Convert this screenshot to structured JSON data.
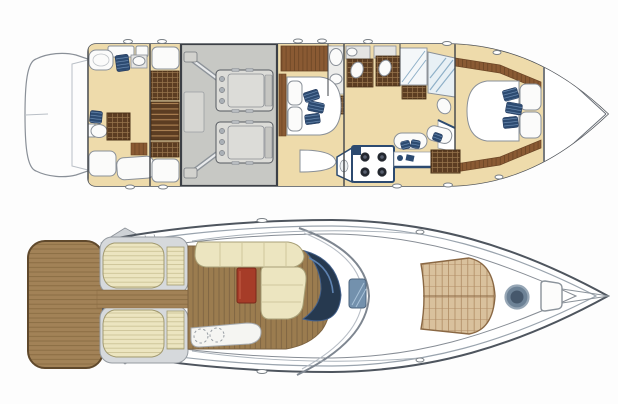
{
  "figure": {
    "title": "yacht-deck-plans",
    "description": "Two-view top-down floor plan of a flybridge motor yacht: lower accommodation deck (top) and main exterior deck (bottom). No text labels are present in the image.",
    "views": [
      {
        "id": "lower-deck-plan",
        "features": [
          "stern-swim-platform-outline",
          "aft-cabin",
          "aft-head-bathtub",
          "aft-head-toilet",
          "navy-towels",
          "wardrobe",
          "guest-berths",
          "companionway-stairs",
          "engine-room",
          "port-engine",
          "starboard-engine",
          "propeller-shafts",
          "generator",
          "master-cabin",
          "master-bed-with-pillows",
          "navy-scatter-cushions",
          "master-head-toilet-sink",
          "wood-cabinetry",
          "galley-stove-four-burners",
          "galley-counters",
          "dinette-seats",
          "shower-rooms-with-glass",
          "vip-bow-cabin",
          "vip-island-bed-with-pillows",
          "wood-walkway-trim",
          "bow-void",
          "hull-cleats"
        ]
      },
      {
        "id": "main-deck-plan",
        "features": [
          "teak-swim-platform",
          "transom-steps",
          "cockpit-bench-sunpad-port",
          "cockpit-bench-sunpad-starboard",
          "cockpit-side-steps",
          "teak-cockpit-salon-floor",
          "l-shaped-cream-sofa",
          "red-cockpit-table",
          "aft-sunbed-wet-bar",
          "dashed-sink-circles",
          "navy-windshield",
          "superstructure-arch",
          "foredeck-glass-hatch",
          "tan-bow-sunpad",
          "round-deck-hatch",
          "anchor-locker",
          "bow-pulpit-lines",
          "stern-railing-ticks",
          "hull-cleats"
        ]
      }
    ]
  },
  "colors": {
    "canvas_bg": "#fdfdfd",
    "hull_line": "#4a4e54",
    "line_gray": "#8a9098",
    "line_light": "#b9bfc6",
    "floor_beige": "#eedbab",
    "engine_room": "#c7c8c4",
    "engine": "#dcdcd8",
    "wood_dark": "#5c3d22",
    "wood_grid_line": "#97744c",
    "wood_medium": "#8a5a33",
    "teak": "#9b7c4f",
    "teak_line": "#7a6140",
    "platform_teak": "#a28257",
    "platform_teak_line": "#86693f",
    "cream": "#ece5c0",
    "cream_line": "#c8bf92",
    "sunpad_tan": "#d9c19d",
    "sunpad_line": "#ae8a62",
    "table_red": "#a63c28",
    "navy": "#2c4a70",
    "navy_stripe": "#6f8fb5",
    "windshield": "#26394f",
    "windshield_highlight": "#5e82b0",
    "hatch_blue": "#7391ad",
    "shower_blue": "#8fb0c8"
  }
}
